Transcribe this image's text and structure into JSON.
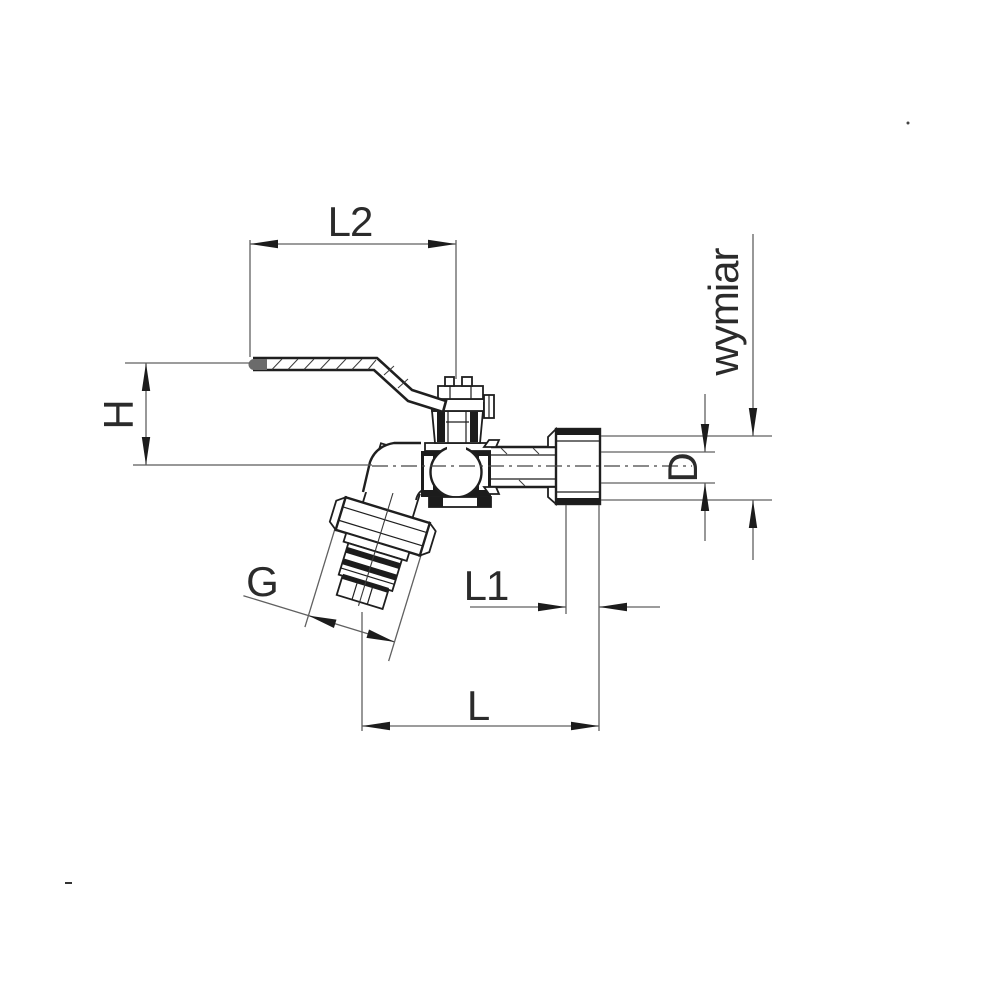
{
  "diagram": {
    "type": "technical-drawing",
    "subject": "ball-valve garden tap (bibcock) cross-section with dimension callouts",
    "background_color": "#ffffff",
    "colors": {
      "outline": "#1f1f1f",
      "dimension_line": "#606060",
      "label_text": "#2b2b2b",
      "section_fill": "#1c1c1c"
    },
    "labels": {
      "l2": "L2",
      "h": "H",
      "wymiar": "wymiar",
      "d": "D",
      "g": "G",
      "l1": "L1",
      "l": "L"
    }
  }
}
